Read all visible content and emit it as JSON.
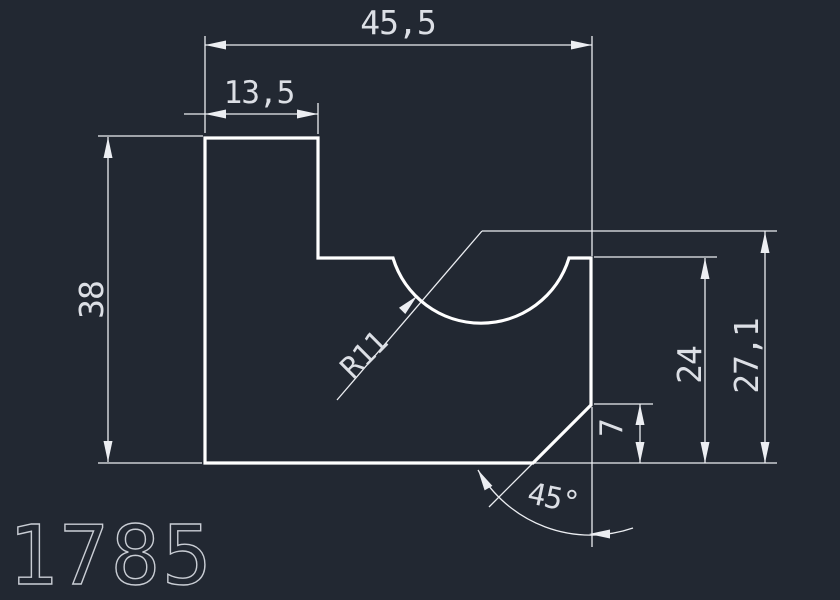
{
  "meta": {
    "background_color": "#222832",
    "outline_color": "#ffffff",
    "dimension_color": "#eceef2",
    "label_color": "#dcdfe5"
  },
  "labels": {
    "overall_width": "45,5",
    "upper_step_width": "13,5",
    "overall_height": "38",
    "notch_radius": "R11",
    "right_edge_height": "24",
    "notch_center_height": "27,1",
    "chamfer_height": "7",
    "chamfer_angle": "45°",
    "part_number": "1785"
  },
  "drawing": {
    "outline_path": "M 205 138 L 318 138 L 318 258 L 393 258 A 92 92 0 0 0 569 258 L 591 258 L 591 405 L 533 463 L 205 463 Z",
    "outline_stroke_width": 3.2,
    "dim_stroke_width": 1.3,
    "dimension_lines": [
      [
        205,
        45,
        592,
        45
      ],
      [
        184,
        114,
        318,
        114
      ],
      [
        108,
        137,
        108,
        462
      ],
      [
        705,
        258,
        705,
        463
      ],
      [
        765,
        231,
        765,
        463
      ],
      [
        640,
        404,
        640,
        463
      ]
    ],
    "extension_lines": [
      [
        205,
        36,
        205,
        133
      ],
      [
        592,
        36,
        592,
        256
      ],
      [
        318,
        103,
        318,
        134
      ],
      [
        98,
        136,
        203,
        136
      ],
      [
        98,
        463,
        202,
        463
      ],
      [
        594,
        257,
        717,
        257
      ],
      [
        594,
        404,
        653,
        404
      ],
      [
        520,
        463,
        777,
        463
      ],
      [
        337,
        400,
        482,
        231
      ],
      [
        482,
        231,
        777,
        231
      ],
      [
        533,
        463,
        489,
        507
      ],
      [
        592,
        407,
        592,
        547
      ]
    ],
    "arc_paths": [
      "M 478 470 A 130 130 0 0 0 633 528"
    ],
    "arrowheads": [
      {
        "tip": [
          205,
          45
        ],
        "angle": 180
      },
      {
        "tip": [
          592,
          45
        ],
        "angle": 0
      },
      {
        "tip": [
          205,
          114
        ],
        "angle": 180
      },
      {
        "tip": [
          318,
          114
        ],
        "angle": 0
      },
      {
        "tip": [
          108,
          137
        ],
        "angle": 270
      },
      {
        "tip": [
          108,
          462
        ],
        "angle": 90
      },
      {
        "tip": [
          417,
          296
        ],
        "angle": 315
      },
      {
        "tip": [
          705,
          258
        ],
        "angle": 270
      },
      {
        "tip": [
          705,
          463
        ],
        "angle": 90
      },
      {
        "tip": [
          765,
          232
        ],
        "angle": 270
      },
      {
        "tip": [
          765,
          463
        ],
        "angle": 90
      },
      {
        "tip": [
          640,
          404
        ],
        "angle": 270
      },
      {
        "tip": [
          640,
          463
        ],
        "angle": 90
      },
      {
        "tip": [
          589,
          534
        ],
        "angle": 180
      },
      {
        "tip": [
          478,
          470
        ],
        "angle": 240
      }
    ],
    "arrow_length": 21,
    "arrow_half_width": 4.5
  }
}
